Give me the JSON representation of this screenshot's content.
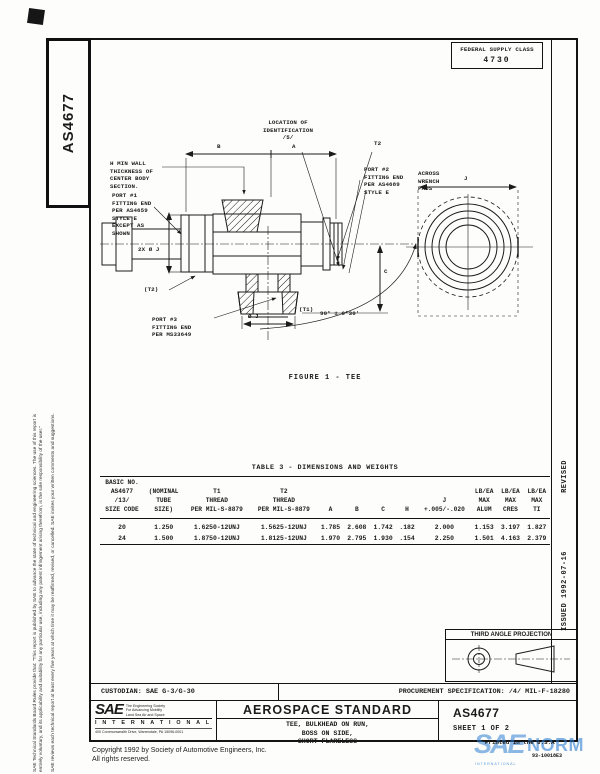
{
  "colors": {
    "ink": "#1b1b1b",
    "watermark_blue": "#2e7fd2"
  },
  "left_margin": {
    "doc_number": "AS4677",
    "disclaimer_1": "SAE Technical Standards Board Rules provide that: \"This report is published by SAE to advance the state of technical and engineering sciences. The use of this report is",
    "disclaimer_2": "entirely voluntary, and its applicability and suitability for any particular use, including any patent infringement arising therefrom, is the sole responsibility of the user.\"",
    "disclaimer_3": "SAE reviews each technical report at least every five years at which time it may be reaffirmed, revised, or cancelled. SAE invites your written comments and suggestions."
  },
  "header": {
    "fsc_label": "FEDERAL SUPPLY CLASS",
    "fsc_value": "4730"
  },
  "right_margin": {
    "revised": "REVISED",
    "issued": "ISSUED 1992-07-16"
  },
  "figure": {
    "caption": "FIGURE 1 - TEE",
    "labels": {
      "location_id": "LOCATION OF\nIDENTIFICATION\n/5/",
      "dim_b": "B",
      "dim_a": "A",
      "wall_note": "H MIN WALL\nTHICKNESS OF\nCENTER BODY\nSECTION.",
      "t2": "T2",
      "port2": "PORT #2\nFITTING END\nPER AS4689\nSTYLE E",
      "across_wrench_pads": "ACROSS\nWRENCH\nPADS",
      "dim_j": "J",
      "port1": "PORT #1\nFITTING END\nPER AS4659\nSTYLE E\nEXCEPT AS\nSHOWN",
      "dia_2x_j": "2X Ø J",
      "t2_ref": "(T2)",
      "port3": "PORT #3\nFITTING END\nPER MS33649",
      "t1_ref": "(T1)",
      "dia_j": "Ø J",
      "angle": "90° ± 0°30'",
      "dim_c": "C"
    }
  },
  "table": {
    "title": "TABLE 3 - DIMENSIONS AND WEIGHTS",
    "headers": [
      "BASIC NO.\nAS4677\n/13/\nSIZE CODE",
      "(NOMINAL\nTUBE\nSIZE)",
      "T1\nTHREAD\nPER MIL-S-8879",
      "T2\nTHREAD\nPER MIL-S-8879",
      "A",
      "B",
      "C",
      "H",
      "J\n+.005/-.020",
      "LB/EA\nMAX\nALUM",
      "LB/EA\nMAX\nCRES",
      "LB/EA\nMAX\nTI"
    ],
    "rows": [
      [
        "20",
        "1.250",
        "1.6250-12UNJ",
        "1.5625-12UNJ",
        "1.785",
        "2.608",
        "1.742",
        ".182",
        "2.000",
        "1.153",
        "3.197",
        "1.827"
      ],
      [
        "24",
        "1.500",
        "1.8750-12UNJ",
        "1.8125-12UNJ",
        "1.970",
        "2.795",
        "1.930",
        ".154",
        "2.250",
        "1.501",
        "4.163",
        "2.379"
      ]
    ]
  },
  "projection": {
    "title": "THIRD ANGLE PROJECTION"
  },
  "title_block": {
    "custodian": "CUSTODIAN:  SAE G-3/G-30",
    "procurement": "PROCUREMENT SPECIFICATION:  /4/ MIL-F-18280",
    "logo_sae": "SAE",
    "logo_tagline": "The Engineering Society\nFor Advancing Mobility\nLand Sea Air and Space",
    "logo_international": "I N T E R N A T I O N A L",
    "logo_address": "400 Commonwealth Drive, Warrendale, PA 15096-0001",
    "doc_type": "AEROSPACE STANDARD",
    "doc_title": "TEE, BULKHEAD ON RUN,\nBOSS ON SIDE,\nSHORT FLARELESS",
    "doc_number": "AS4677",
    "sheet": "SHEET 1 OF 2"
  },
  "footer": {
    "copyright_line1": "Copyright  1992  by Society of Automotive Engineers, Inc.",
    "copyright_line2": "All rights reserved.",
    "printed": "Printed in the U.S.A",
    "stamp_code": "93-10018E3",
    "watermark_sae": "SAE",
    "watermark_norm": "NORM",
    "watermark_sub": "INTERNATIONAL"
  }
}
